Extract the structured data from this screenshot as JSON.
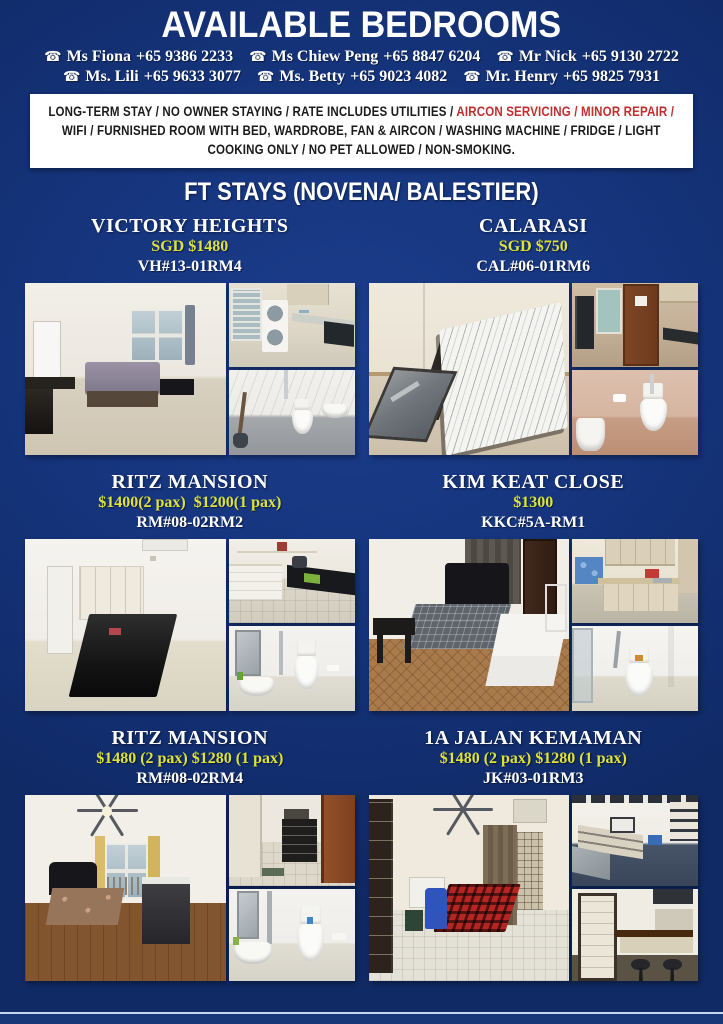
{
  "header": {
    "title": "AVAILABLE BEDROOMS",
    "section_title": "FT STAYS (NOVENA/ BALESTIER)"
  },
  "icons": {
    "phone": "☎"
  },
  "contacts": {
    "row1": [
      {
        "name": "Ms Fiona",
        "phone": "+65 9386 2233"
      },
      {
        "name": "Ms Chiew Peng",
        "phone": "+65 8847 6204"
      },
      {
        "name": "Mr Nick",
        "phone": "+65 9130 2722"
      }
    ],
    "row2": [
      {
        "name": "Ms. Lili",
        "phone": "+65 9633 3077"
      },
      {
        "name": "Ms. Betty",
        "phone": "+65 9023 4082"
      },
      {
        "name": "Mr. Henry",
        "phone": "+65 9825 7931"
      }
    ]
  },
  "terms": {
    "part1": "LONG-TERM STAY / NO OWNER STAYING / RATE INCLUDES UTILITIES / ",
    "highlight": "AIRCON SERVICING / MINOR REPAIR /",
    "part2": " WIFI / FURNISHED ROOM WITH BED, WARDROBE, FAN & AIRCON / WASHING MACHINE / FRIDGE / LIGHT COOKING ONLY / NO PET ALLOWED / NON-SMOKING."
  },
  "listings": [
    {
      "name": "VICTORY HEIGHTS",
      "price": "SGD $1480",
      "unit": "VH#13-01RM4",
      "photos": [
        "bedroom",
        "laundry-kitchen",
        "bathroom"
      ]
    },
    {
      "name": "CALARASI",
      "price": "SGD $750",
      "unit": "CAL#06-01RM6",
      "photos": [
        "bedroom",
        "kitchen",
        "bathroom"
      ]
    },
    {
      "name": "RITZ MANSION",
      "price": "$1400(2 pax)  $1200(1 pax)",
      "unit": "RM#08-02RM2",
      "photos": [
        "bedroom",
        "kitchen",
        "bathroom"
      ]
    },
    {
      "name": "KIM KEAT CLOSE",
      "price": "$1300",
      "unit": "KKC#5A-RM1",
      "photos": [
        "bedroom",
        "kitchen",
        "bathroom"
      ]
    },
    {
      "name": "RITZ MANSION",
      "price": "$1480 (2 pax) $1280 (1 pax)",
      "unit": "RM#08-02RM4",
      "photos": [
        "bedroom",
        "entryway",
        "bathroom"
      ]
    },
    {
      "name": "1A JALAN KEMAMAN",
      "price": "$1480 (2 pax) $1280 (1 pax)",
      "unit": "JK#03-01RM3",
      "photos": [
        "bedroom",
        "kitchen",
        "dining-bar"
      ]
    }
  ],
  "colors": {
    "background_blue": "#16357e",
    "price_yellow": "#dee23a",
    "terms_red": "#c02f2f",
    "banner_bg": "#ffffff",
    "text_white": "#ffffff"
  }
}
